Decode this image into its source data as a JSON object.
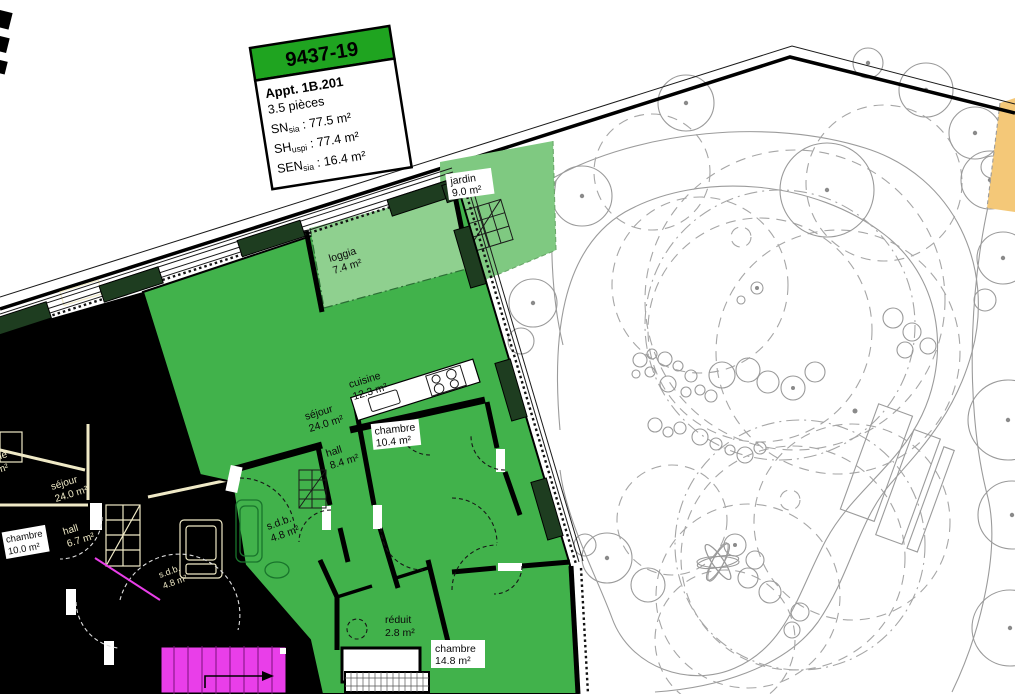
{
  "label_box": {
    "code": "9437-19",
    "apartment": "Appt. 1B.201",
    "pieces": "3.5 pièces",
    "metrics": {
      "sn": {
        "label": "SN",
        "sub": "sia",
        "value": " : 77.5 m²"
      },
      "sh": {
        "label": "SH",
        "sub": "uspi",
        "value": " : 77.4 m²"
      },
      "sen": {
        "label": "SEN",
        "sub": "sia",
        "value": " : 16.4 m²"
      }
    }
  },
  "rooms": {
    "jardin": {
      "name": "jardin",
      "area": "9.0 m²"
    },
    "loggia": {
      "name": "loggia",
      "area": "7.4 m²"
    },
    "cuisine": {
      "name": "cuisine",
      "area": "12.3 m²"
    },
    "sejour": {
      "name": "séjour",
      "area": "24.0 m²"
    },
    "chambre1": {
      "name": "chambre",
      "area": "10.4 m²"
    },
    "hall": {
      "name": "hall",
      "area": "8.4 m²"
    },
    "sdb": {
      "name": "s.d.b.",
      "area": "4.8 m²"
    },
    "reduit": {
      "name": "réduit",
      "area": "2.8 m²"
    },
    "chambre2": {
      "name": "chambre",
      "area": "14.8 m²"
    }
  },
  "neighbor_rooms": {
    "sejour": {
      "name": "séjour",
      "area": "24.0 m²"
    },
    "hall": {
      "name": "hall",
      "area": "6.7 m²"
    },
    "chambre": {
      "name": "chambre",
      "area": "10.0 m²"
    },
    "sdb": {
      "name": "s.d.b.",
      "area": "4.8 m²"
    },
    "cuisine": {
      "name": "cuisine",
      "area": "9.3 m²"
    }
  },
  "colors": {
    "apartment_green": "#41B24B",
    "loggia_green": "#8FD08F",
    "jardin_green": "#7FC981",
    "label_header_green": "#1FA420",
    "facade_pillar_green": "#1E3D20",
    "neighbor_black": "#000000",
    "neighbor_beige": "#EFE9C6",
    "stair_magenta": "#E93EE9",
    "terrain_orange": "#F4C878",
    "tree_gray": "#9A9A9A"
  }
}
